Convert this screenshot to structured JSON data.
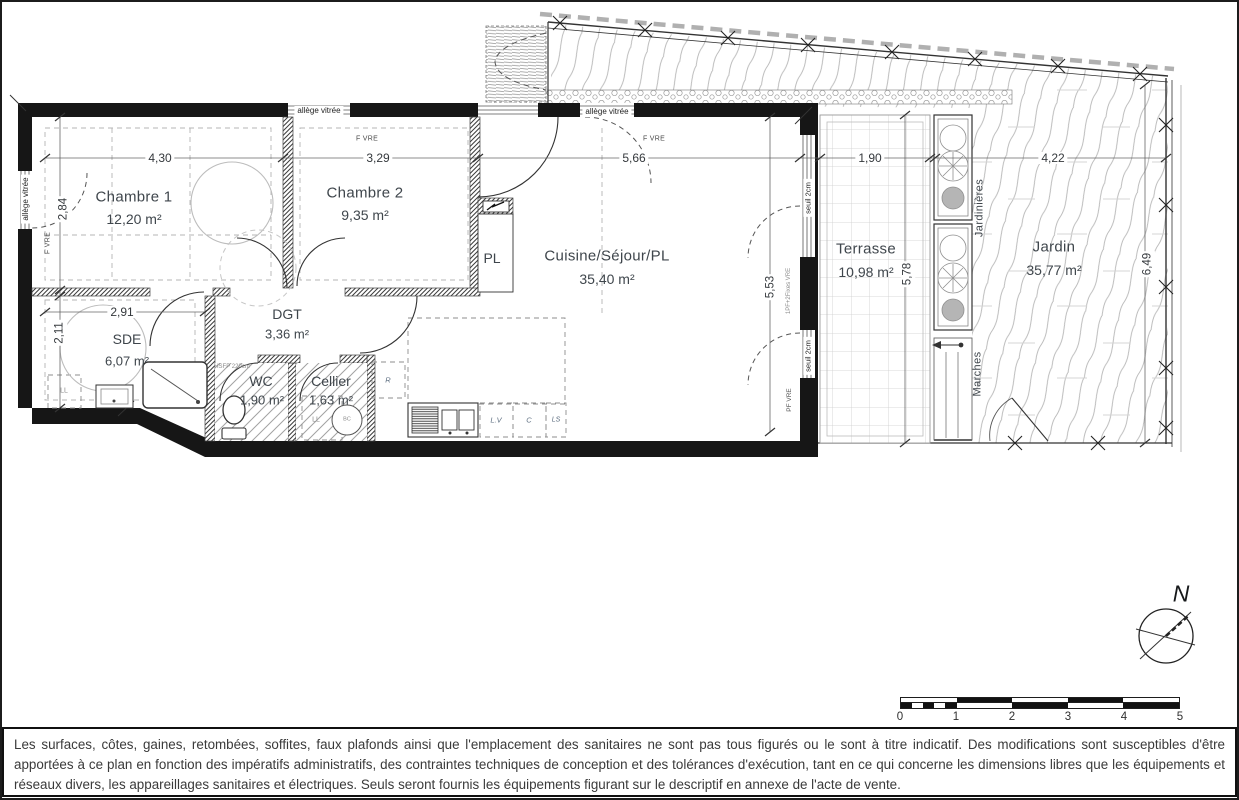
{
  "plan": {
    "rooms": [
      {
        "name": "Chambre 1",
        "area": "12,20 m²"
      },
      {
        "name": "Chambre 2",
        "area": "9,35 m²"
      },
      {
        "name": "Cuisine/Séjour/PL",
        "area": "35,40 m²"
      },
      {
        "name": "SDE",
        "area": "6,07 m²"
      },
      {
        "name": "DGT",
        "area": "3,36 m²"
      },
      {
        "name": "WC",
        "area": "1,90 m²"
      },
      {
        "name": "Cellier",
        "area": "1,63 m²"
      },
      {
        "name": "PL"
      },
      {
        "name": "Terrasse",
        "area": "10,98 m²"
      },
      {
        "name": "Jardin",
        "area": "35,77 m²"
      }
    ],
    "outdoor": {
      "jardinieres": "Jardinières",
      "marches": "Marches"
    },
    "dimensions": {
      "top_chambre1": "4,30",
      "top_chambre2": "3,29",
      "top_sejour": "5,66",
      "top_terrasse": "1,90",
      "top_jardin": "4,22",
      "left_chambre1": "2,84",
      "sde_width": "2,91",
      "left_sde": "2,11",
      "right_sejour": "5,53",
      "terrasse_height": "5,78",
      "jardin_height": "6,49"
    },
    "annotations": {
      "allege": "allège vitrée",
      "f_vre": "F VRE",
      "seuil": "seuil 2cm",
      "pf_vre": "PF VRE",
      "pf_2fixes": "1PF+2Fixes VRE",
      "hsfp": "HSFP 220cm",
      "ll": "LL",
      "r": "R",
      "lv": "L.V",
      "c": "C",
      "ls": "LS",
      "bc": "BC"
    }
  },
  "compass": {
    "label": "N"
  },
  "scale_bar": {
    "ticks": [
      "0",
      "1",
      "2",
      "3",
      "4",
      "5"
    ]
  },
  "disclaimer": "Les surfaces, côtes, gaines, retombées, soffites, faux plafonds ainsi que l'emplacement des sanitaires ne sont pas tous figurés ou le sont à titre indicatif. Des modifications sont susceptibles d'être apportées à ce plan en fonction des impératifs administratifs, des contraintes techniques de conception et des tolérances d'exécution, tant en ce qui concerne les dimensions libres que les équipements et réseaux divers, les appareillages sanitaires et électriques. Seuls seront fournis les équipements figurant sur le descriptif en annexe de l'acte de vente."
}
